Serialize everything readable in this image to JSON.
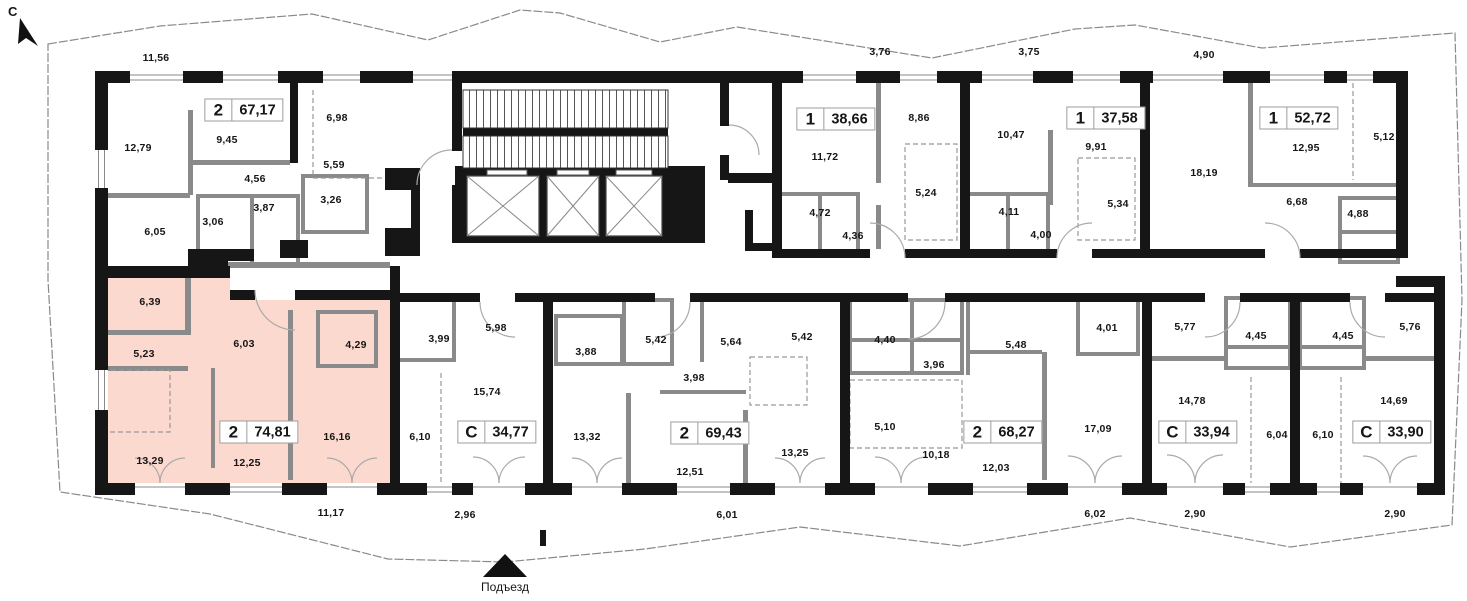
{
  "plan": {
    "north_label": "С",
    "entrance_label": "Подъезд"
  },
  "colors": {
    "highlight_fill": "#fcd9ce",
    "wall": "#161616",
    "partition": "#8a8a8a"
  },
  "apartments": [
    {
      "type": "2",
      "area": "67,17",
      "highlighted": false,
      "box": {
        "x": 244,
        "y": 110
      },
      "rooms": [
        {
          "v": "12,79",
          "x": 138,
          "y": 148
        },
        {
          "v": "9,45",
          "x": 227,
          "y": 140
        },
        {
          "v": "6,98",
          "x": 337,
          "y": 118
        },
        {
          "v": "5,59",
          "x": 334,
          "y": 165
        },
        {
          "v": "4,56",
          "x": 255,
          "y": 179
        },
        {
          "v": "3,87",
          "x": 264,
          "y": 208
        },
        {
          "v": "3,26",
          "x": 331,
          "y": 200
        },
        {
          "v": "3,06",
          "x": 213,
          "y": 222
        },
        {
          "v": "6,05",
          "x": 155,
          "y": 232
        }
      ]
    },
    {
      "type": "1",
      "area": "38,66",
      "highlighted": false,
      "box": {
        "x": 836,
        "y": 119
      },
      "rooms": [
        {
          "v": "11,72",
          "x": 825,
          "y": 157
        },
        {
          "v": "8,86",
          "x": 919,
          "y": 118
        },
        {
          "v": "5,24",
          "x": 926,
          "y": 193
        },
        {
          "v": "4,72",
          "x": 820,
          "y": 213
        },
        {
          "v": "4,36",
          "x": 853,
          "y": 236
        }
      ]
    },
    {
      "type": "1",
      "area": "37,58",
      "highlighted": false,
      "box": {
        "x": 1106,
        "y": 118
      },
      "rooms": [
        {
          "v": "10,47",
          "x": 1011,
          "y": 135
        },
        {
          "v": "9,91",
          "x": 1096,
          "y": 147
        },
        {
          "v": "5,34",
          "x": 1118,
          "y": 204
        },
        {
          "v": "4,11",
          "x": 1009,
          "y": 212
        },
        {
          "v": "4,00",
          "x": 1041,
          "y": 235
        }
      ]
    },
    {
      "type": "1",
      "area": "52,72",
      "highlighted": false,
      "box": {
        "x": 1299,
        "y": 118
      },
      "rooms": [
        {
          "v": "18,19",
          "x": 1204,
          "y": 173
        },
        {
          "v": "12,95",
          "x": 1306,
          "y": 148
        },
        {
          "v": "5,12",
          "x": 1384,
          "y": 137
        },
        {
          "v": "6,68",
          "x": 1297,
          "y": 202
        },
        {
          "v": "4,88",
          "x": 1358,
          "y": 214
        }
      ]
    },
    {
      "type": "2",
      "area": "74,81",
      "highlighted": true,
      "box": {
        "x": 259,
        "y": 432
      },
      "rooms": [
        {
          "v": "6,39",
          "x": 150,
          "y": 302
        },
        {
          "v": "5,23",
          "x": 144,
          "y": 354
        },
        {
          "v": "6,03",
          "x": 244,
          "y": 344
        },
        {
          "v": "4,29",
          "x": 356,
          "y": 345
        },
        {
          "v": "13,29",
          "x": 150,
          "y": 461
        },
        {
          "v": "12,25",
          "x": 247,
          "y": 463
        },
        {
          "v": "16,16",
          "x": 337,
          "y": 437
        }
      ]
    },
    {
      "type": "С",
      "area": "34,77",
      "highlighted": false,
      "box": {
        "x": 497,
        "y": 432
      },
      "rooms": [
        {
          "v": "5,98",
          "x": 496,
          "y": 328
        },
        {
          "v": "3,99",
          "x": 439,
          "y": 339
        },
        {
          "v": "15,74",
          "x": 487,
          "y": 392
        },
        {
          "v": "6,10",
          "x": 420,
          "y": 437
        }
      ]
    },
    {
      "type": "2",
      "area": "69,43",
      "highlighted": false,
      "box": {
        "x": 710,
        "y": 433
      },
      "rooms": [
        {
          "v": "3,88",
          "x": 586,
          "y": 352
        },
        {
          "v": "5,42",
          "x": 656,
          "y": 340
        },
        {
          "v": "5,64",
          "x": 731,
          "y": 342
        },
        {
          "v": "5,42",
          "x": 802,
          "y": 337
        },
        {
          "v": "3,98",
          "x": 694,
          "y": 378
        },
        {
          "v": "13,32",
          "x": 587,
          "y": 437
        },
        {
          "v": "12,51",
          "x": 690,
          "y": 472
        },
        {
          "v": "13,25",
          "x": 795,
          "y": 453
        }
      ]
    },
    {
      "type": "2",
      "area": "68,27",
      "highlighted": false,
      "box": {
        "x": 1003,
        "y": 432
      },
      "rooms": [
        {
          "v": "4,40",
          "x": 885,
          "y": 340
        },
        {
          "v": "3,96",
          "x": 934,
          "y": 365
        },
        {
          "v": "5,48",
          "x": 1016,
          "y": 345
        },
        {
          "v": "4,01",
          "x": 1107,
          "y": 328
        },
        {
          "v": "5,10",
          "x": 885,
          "y": 427
        },
        {
          "v": "10,18",
          "x": 936,
          "y": 455
        },
        {
          "v": "12,03",
          "x": 996,
          "y": 468
        },
        {
          "v": "17,09",
          "x": 1098,
          "y": 429
        }
      ]
    },
    {
      "type": "С",
      "area": "33,94",
      "highlighted": false,
      "box": {
        "x": 1198,
        "y": 432
      },
      "rooms": [
        {
          "v": "5,77",
          "x": 1185,
          "y": 327
        },
        {
          "v": "4,45",
          "x": 1256,
          "y": 336
        },
        {
          "v": "14,78",
          "x": 1192,
          "y": 401
        },
        {
          "v": "6,04",
          "x": 1277,
          "y": 435
        }
      ]
    },
    {
      "type": "С",
      "area": "33,90",
      "highlighted": false,
      "box": {
        "x": 1392,
        "y": 432
      },
      "rooms": [
        {
          "v": "4,45",
          "x": 1343,
          "y": 336
        },
        {
          "v": "5,76",
          "x": 1410,
          "y": 327
        },
        {
          "v": "14,69",
          "x": 1394,
          "y": 401
        },
        {
          "v": "6,10",
          "x": 1323,
          "y": 435
        }
      ]
    }
  ],
  "outside_labels": [
    {
      "v": "11,56",
      "x": 156,
      "y": 58
    },
    {
      "v": "3,76",
      "x": 880,
      "y": 52
    },
    {
      "v": "3,75",
      "x": 1029,
      "y": 52
    },
    {
      "v": "4,90",
      "x": 1204,
      "y": 55
    },
    {
      "v": "11,17",
      "x": 331,
      "y": 513
    },
    {
      "v": "2,96",
      "x": 465,
      "y": 515
    },
    {
      "v": "6,01",
      "x": 727,
      "y": 515
    },
    {
      "v": "6,02",
      "x": 1095,
      "y": 514
    },
    {
      "v": "2,90",
      "x": 1195,
      "y": 514
    },
    {
      "v": "2,90",
      "x": 1395,
      "y": 514
    }
  ]
}
